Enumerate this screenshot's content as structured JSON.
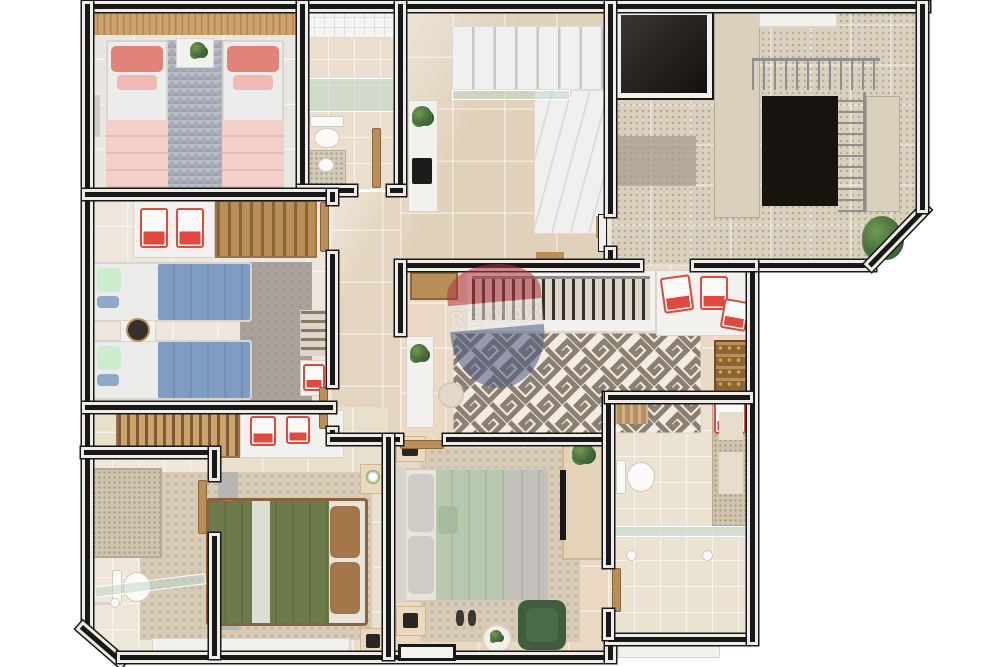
{
  "watermark": {
    "text": "RE/MAX",
    "balloon_top_color": "#b03540",
    "balloon_band_color": "#e8e6e2",
    "balloon_bottom_color": "#4a5a80",
    "opacity": 0.55
  },
  "palette": {
    "wall_line": "#181818",
    "wall_cap": "#efece7",
    "floor_light": "#e9e6e2",
    "floor_tile_beige": "#e6d8c2",
    "floor_tile_pink": "#ecd9c5",
    "floor_granite": "#d9d0bd",
    "marble": "#f0f0ee",
    "wood": "#b98e59",
    "wood_slat": "#cda26c",
    "accent_red": "#e2483d",
    "bed_pink_pillow": "#e2837a",
    "bed_pink_blanket": "#f2cfc8",
    "bed_blue": "#7f9cc2",
    "bed_mint_pillow": "#cdeccd",
    "bed_olive": "#6d7a4a",
    "bed_sage": "#b9c9af",
    "pillow_brown": "#a3764a",
    "armchair_green": "#3f5d3e",
    "rug_gray_diamond": "#b9bdc6",
    "rug_gray": "#a9a29c",
    "rug_beige": "#d8cbb6",
    "rug_maze_brown": "#8b7f72",
    "rug_maze_cream": "#f3ece1",
    "glass": "#bad8c8",
    "plant_green": "#4e7a43",
    "railing_gray": "#8f8f8f",
    "wm_red": "#b03540",
    "wm_band": "#e8e6e2",
    "wm_blue": "#4a5a80"
  },
  "scene": {
    "type": "3D architectural floor plan render, top-down view, white background",
    "rooms": [
      {
        "name": "twin-bedroom-pink",
        "contents": [
          "wood slat accent wall",
          "two single beds with coral and pink bedding",
          "gray diamond-pattern rug",
          "nightstand with plant"
        ]
      },
      {
        "name": "bathroom-top",
        "contents": [
          "white tiled wall",
          "tinted glass shower",
          "toilet",
          "granite vanity"
        ]
      },
      {
        "name": "entry-hall",
        "contents": [
          "white console with plant and coffee machine",
          "L-shaped white marble staircase with glass balustrade",
          "large beige floor tiles"
        ]
      },
      {
        "name": "common-stairwell",
        "contents": [
          "dark elevator void",
          "granite tiled stairs",
          "metal railing around stair void",
          "potted plant",
          "white landing"
        ]
      },
      {
        "name": "twin-bedroom-blue",
        "contents": [
          "closet with two red suitcases",
          "wood cubby shelf",
          "two single beds with blue duvets and mint pillows",
          "round dark side table",
          "gray rug",
          "wardrobe nook with red suitcase"
        ]
      },
      {
        "name": "dressing-room",
        "contents": [
          "wood sideboard",
          "open wardrobe with hanging clothes",
          "white counter with red suitcases",
          "shoe shelves",
          "greek-key maze rug",
          "white console with plant",
          "round pouf"
        ]
      },
      {
        "name": "bathroom-left",
        "contents": [
          "granite shower column",
          "toilet",
          "tinted glass screen",
          "shower head"
        ]
      },
      {
        "name": "bedroom-olive",
        "contents": [
          "clothes rack",
          "white cabinet with red boxes",
          "gray TV panel",
          "double bed with olive duvet, white runner and brown pillows",
          "beige rug",
          "two nightstands",
          "white bench"
        ]
      },
      {
        "name": "bedroom-sage",
        "contents": [
          "double bed with sage duvet and gray pillows",
          "two nightstands",
          "slippers",
          "green armchair",
          "round side table with plant",
          "wardrobe with TV and plant",
          "entry door"
        ]
      },
      {
        "name": "bathroom-right",
        "contents": [
          "towel rack",
          "toilet",
          "granite niche wall",
          "tinted glass partition",
          "two shower heads",
          "white entry canopy"
        ]
      }
    ]
  }
}
